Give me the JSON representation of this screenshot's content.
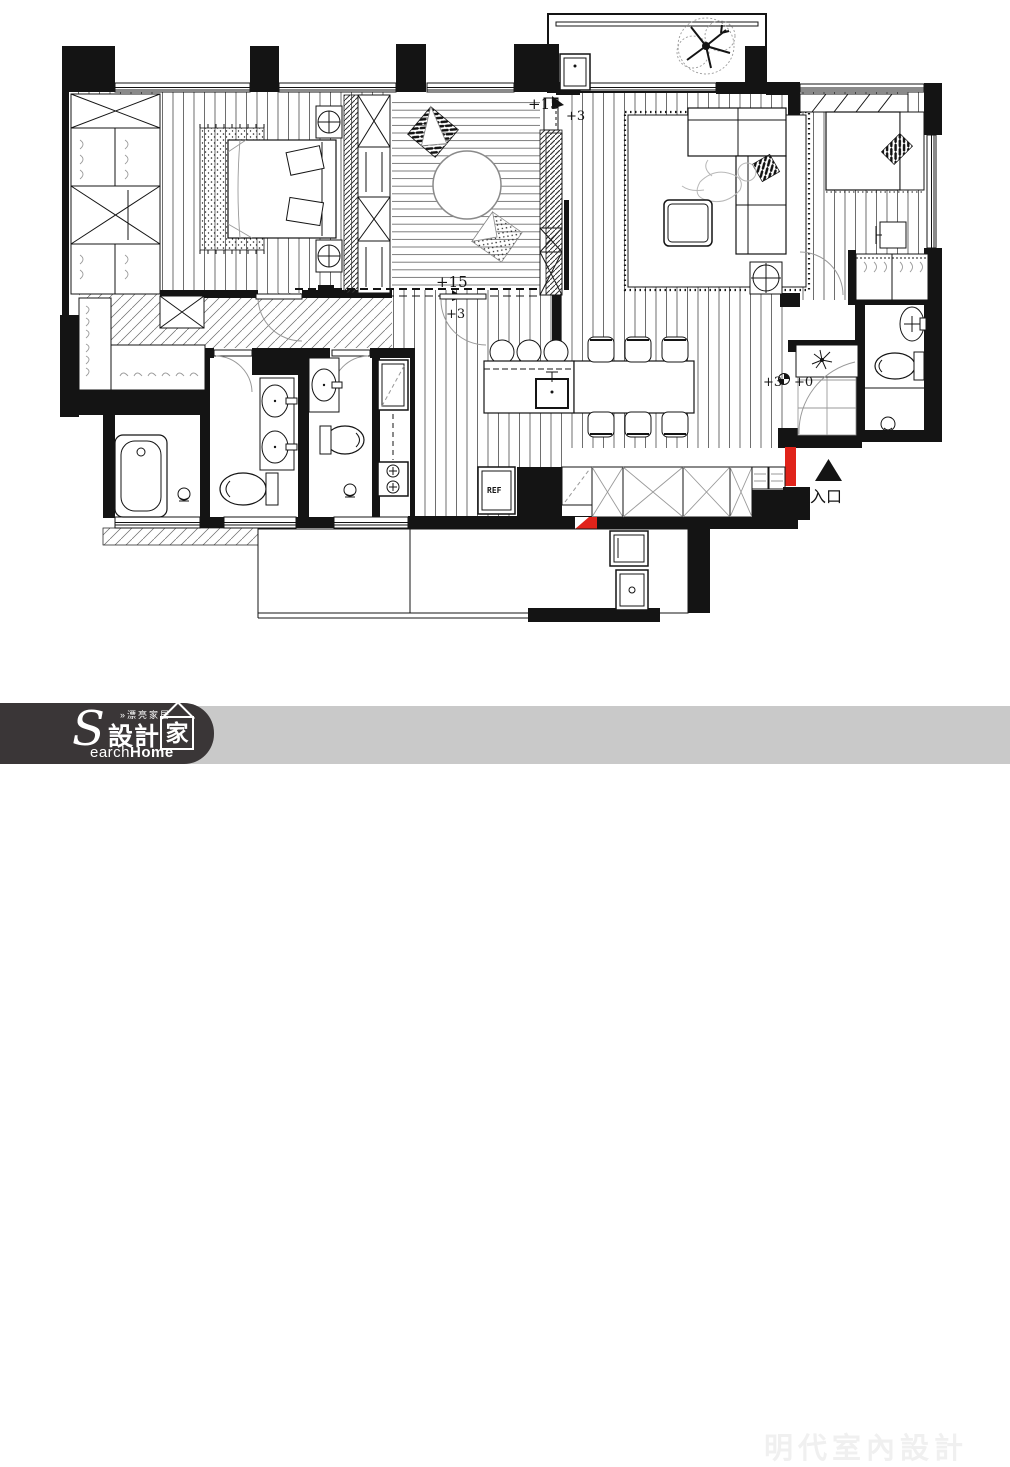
{
  "plan": {
    "levels": {
      "platform_top": {
        "upper": "+15",
        "lower": "+3"
      },
      "platform_bottom": {
        "upper": "+15",
        "lower": "+3"
      },
      "entry": {
        "left": "+3",
        "right": "+0"
      }
    },
    "entrance_label": "入口",
    "fridge_label": "REF"
  },
  "footer": {
    "tagline": "»漂亮家居",
    "brand_initial": "S",
    "brand_cjk_left": "設計",
    "brand_cjk_right": "家",
    "brand_latin_rest": "earch",
    "brand_latin_bold": "Home",
    "company": "明代室內設計"
  },
  "colors": {
    "accent_red": "#e0231a",
    "footer_bg": "#c9c9c9",
    "logo_bg": "#3a3637",
    "ink": "#141414",
    "page_bg": "#ffffff"
  }
}
